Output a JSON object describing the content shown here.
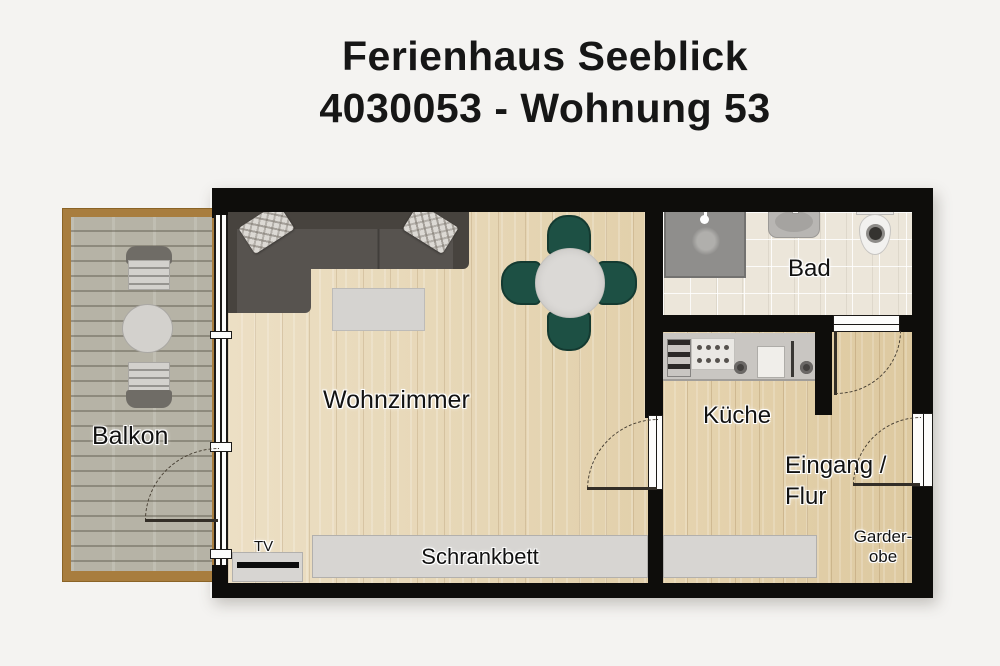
{
  "title": {
    "line1": "Ferienhaus Seeblick",
    "line2": "4030053 - Wohnung 53"
  },
  "rooms": {
    "balkon": "Balkon",
    "wohnzimmer": "Wohnzimmer",
    "bad": "Bad",
    "kueche": "Küche",
    "eingang_line1": "Eingang /",
    "eingang_line2": "Flur",
    "garderobe_line1": "Garder-",
    "garderobe_line2": "obe"
  },
  "furniture_labels": {
    "tv": "TV",
    "schrankbett": "Schrankbett"
  },
  "colors": {
    "background": "#f4f3f1",
    "wall": "#0e0d0b",
    "living_floor": "#e8dabd",
    "hall_floor": "#e2cfa9",
    "bath_tile": "#ece6da",
    "deck": "#b6b3a6",
    "deck_border": "#a87d3e",
    "sofa": "#57534f",
    "dining_chair_green": "#1d5044",
    "furniture_gray": "#d7d5d2"
  }
}
